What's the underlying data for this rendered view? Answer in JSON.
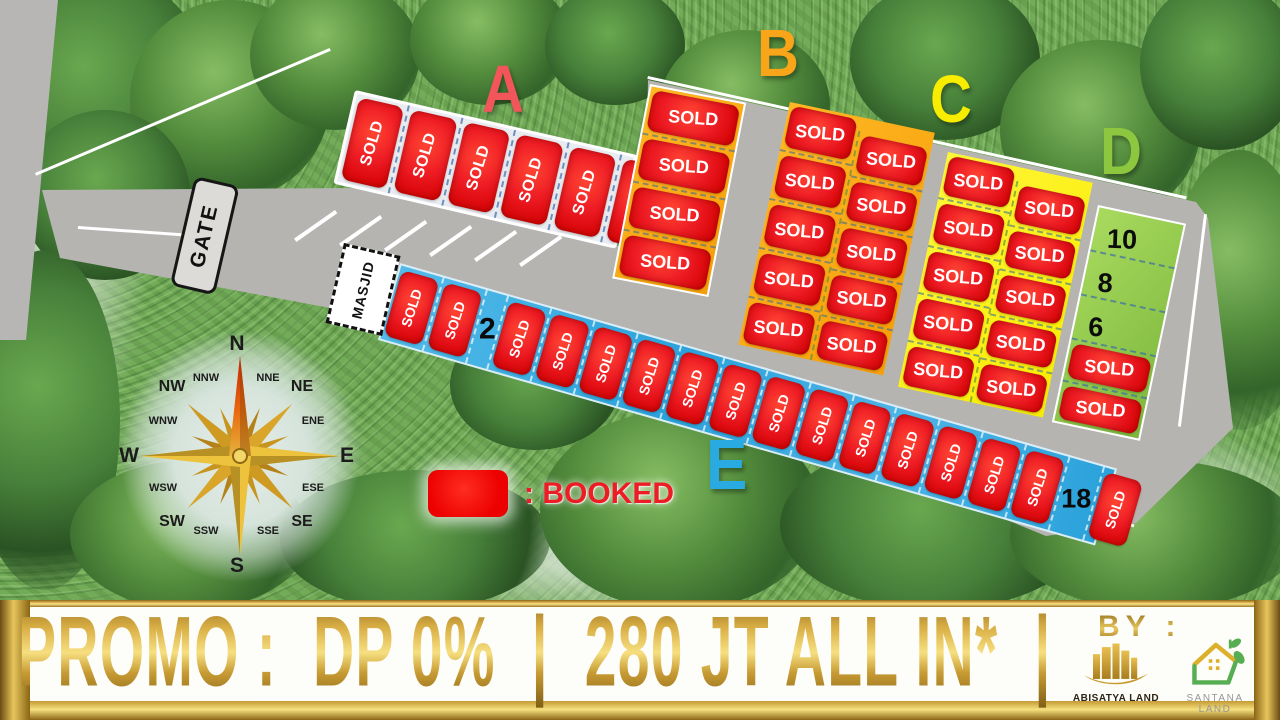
{
  "map": {
    "block_letters": {
      "a": "A",
      "b": "B",
      "c": "C",
      "d": "D",
      "e": "E"
    },
    "gate_label": "GATE",
    "masjid_label": "MASJID",
    "legend": {
      "swatch_color": "#ed1c24",
      "booked_label": ": BOOKED"
    },
    "compass": {
      "labels": [
        "N",
        "NNE",
        "NE",
        "ENE",
        "E",
        "ESE",
        "SE",
        "SSE",
        "S",
        "SSW",
        "SW",
        "WSW",
        "W",
        "WNW",
        "NW",
        "NNW"
      ]
    },
    "blocks": {
      "a": {
        "lots": [
          "SOLD",
          "SOLD",
          "SOLD",
          "SOLD",
          "SOLD",
          "SOLD"
        ]
      },
      "b": {
        "col1": [
          "SOLD",
          "SOLD",
          "SOLD",
          "SOLD"
        ],
        "col2": [
          "SOLD",
          "SOLD",
          "SOLD",
          "SOLD",
          "SOLD"
        ],
        "col3": [
          "SOLD",
          "SOLD",
          "SOLD",
          "SOLD",
          "SOLD"
        ]
      },
      "c": {
        "col1": [
          "SOLD",
          "SOLD",
          "SOLD",
          "SOLD",
          "SOLD"
        ],
        "col2": [
          "SOLD",
          "SOLD",
          "SOLD",
          "SOLD",
          "SOLD"
        ]
      },
      "d": {
        "lots": [
          "10",
          "8",
          "6",
          "SOLD",
          "SOLD"
        ]
      },
      "e": {
        "lots": [
          "SOLD",
          "SOLD",
          "2",
          "SOLD",
          "SOLD",
          "SOLD",
          "SOLD",
          "SOLD",
          "SOLD",
          "SOLD",
          "SOLD",
          "SOLD",
          "SOLD",
          "SOLD",
          "SOLD",
          "SOLD",
          "18",
          "SOLD"
        ]
      }
    },
    "colors": {
      "block_a": "#f2555a",
      "block_b": "#f9a51a",
      "block_c": "#fff200",
      "block_d": "#8dc63f",
      "block_e": "#29abe2",
      "sold_red": "#ed1c24"
    }
  },
  "banner": {
    "promo_items": [
      "PROMO :",
      "DP 0%",
      "|",
      "280 JT ALL IN*",
      "|"
    ],
    "by_label": "BY :",
    "logos": {
      "abisatya_label": "ABISATYA LAND",
      "santana_label": "SANTANA LAND"
    }
  }
}
